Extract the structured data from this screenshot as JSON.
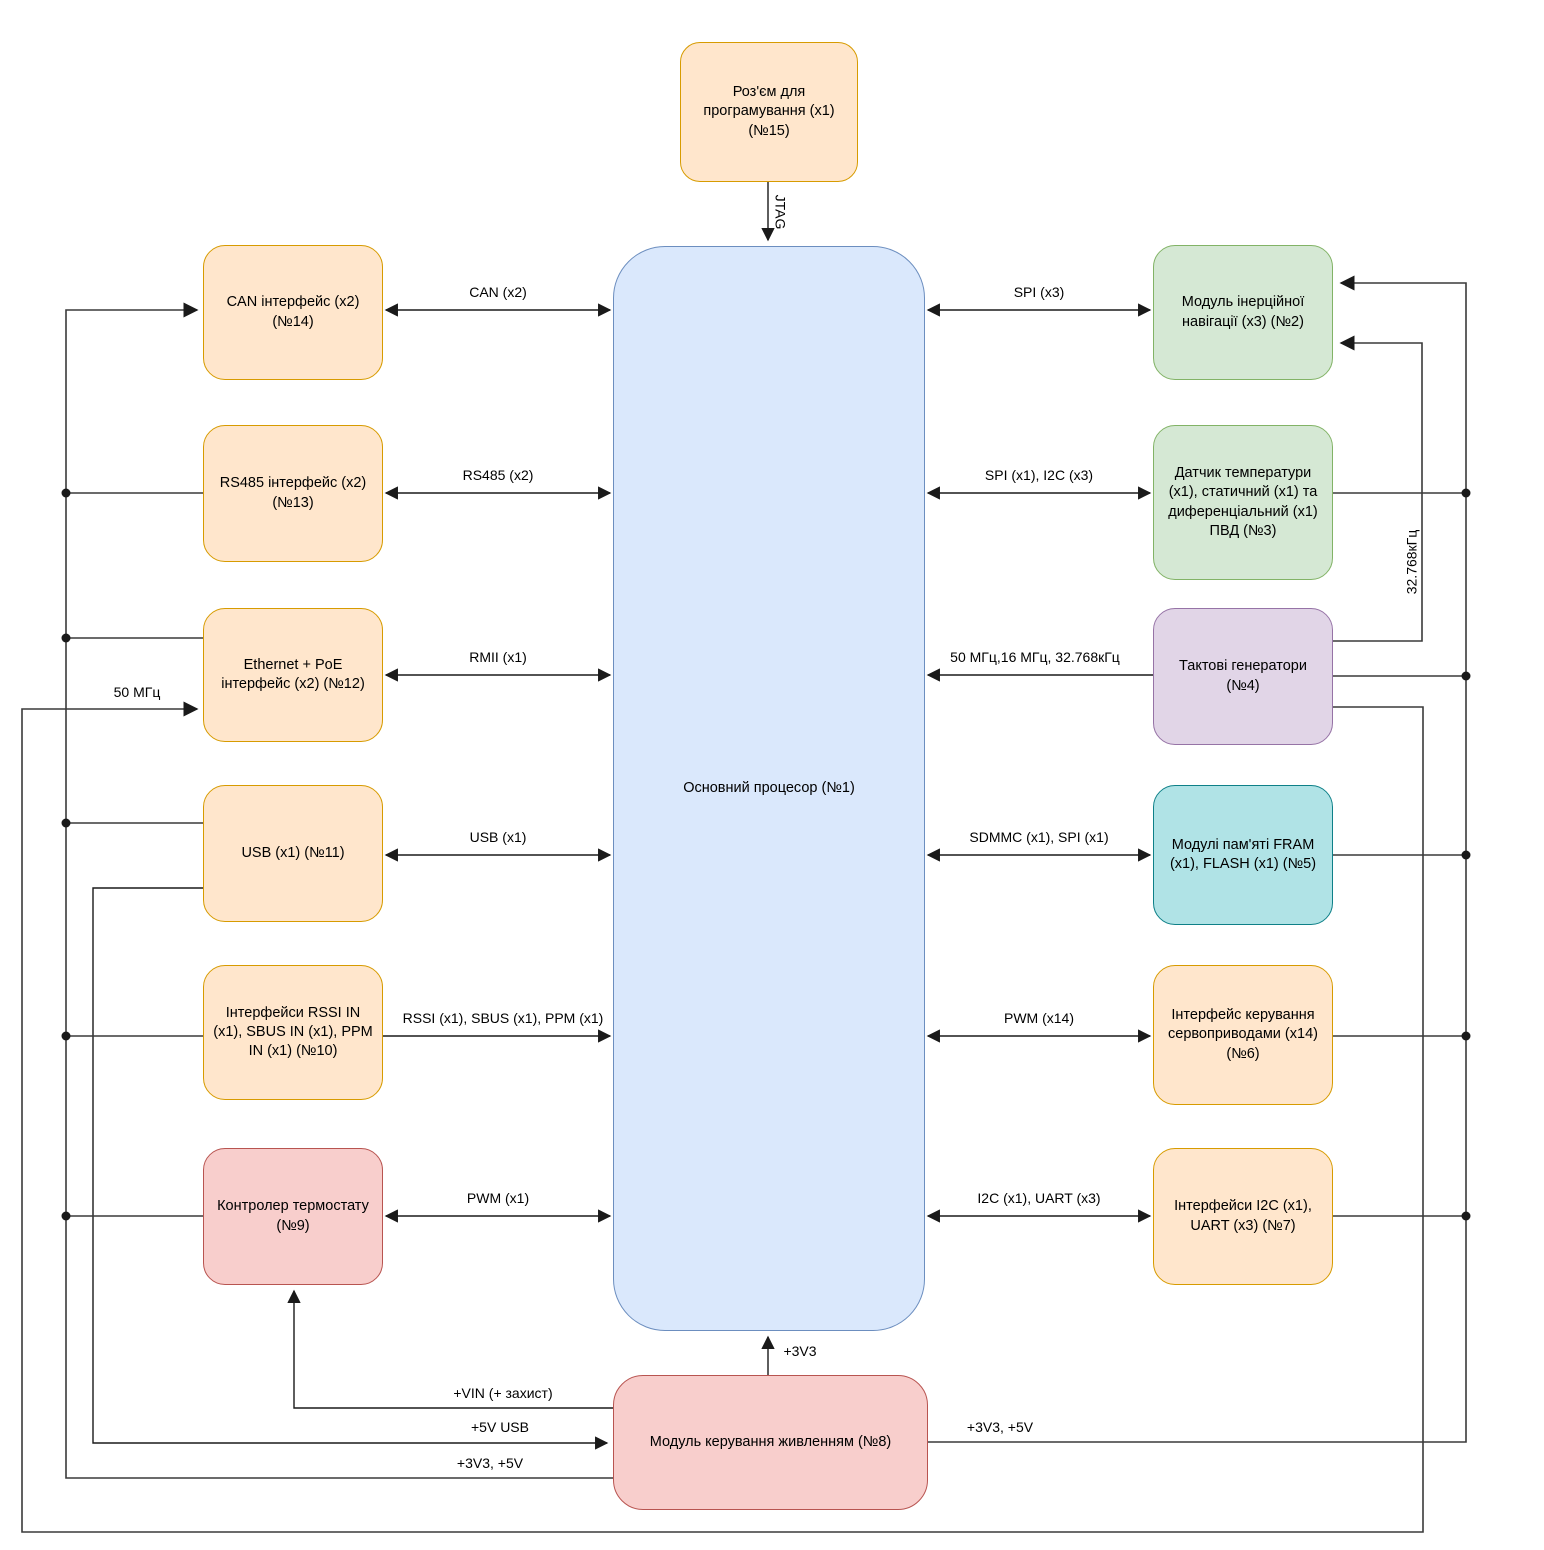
{
  "diagram_title": "",
  "colors": {
    "orange": {
      "fill": "#FFE6CC",
      "stroke": "#D79B00"
    },
    "blue": {
      "fill": "#DAE8FC",
      "stroke": "#6C8EBF"
    },
    "green": {
      "fill": "#D5E8D4",
      "stroke": "#82B366"
    },
    "purple": {
      "fill": "#E1D5E7",
      "stroke": "#9673A6"
    },
    "teal": {
      "fill": "#B0E3E6",
      "stroke": "#0E8088"
    },
    "red": {
      "fill": "#F8CECC",
      "stroke": "#B85450"
    },
    "line": "#1a1a1a"
  },
  "blocks": {
    "programming": {
      "label": "Роз'єм для програмування (x1) (№15)"
    },
    "processor": {
      "label": "Основний процесор (№1)"
    },
    "can": {
      "label": "CAN інтерфейс (x2) (№14)"
    },
    "rs485": {
      "label": "RS485 інтерфейс (x2) (№13)"
    },
    "ethernet": {
      "label": "Ethernet + PoE інтерфейс (x2) (№12)"
    },
    "usb": {
      "label": "USB (x1) (№11)"
    },
    "rc_inputs": {
      "label": "Інтерфейси RSSI IN (x1), SBUS IN (x1), PPM IN (x1) (№10)"
    },
    "thermostat": {
      "label": "Контролер термостату (№9)"
    },
    "imu": {
      "label": "Модуль інерційної навігації (x3) (№2)"
    },
    "sensors": {
      "label": "Датчик температури (x1), статичний (x1) та диференціальний (x1) ПВД (№3)"
    },
    "clocks": {
      "label": "Тактові генератори (№4)"
    },
    "memory": {
      "label": "Модулі пам'яті FRAM (x1), FLASH (x1) (№5)"
    },
    "servo": {
      "label": "Інтерфейс керування сервоприводами (x14) (№6)"
    },
    "i2c_uart": {
      "label": "Інтерфейси I2C (x1), UART (x3) (№7)"
    },
    "power": {
      "label": "Модуль керування живленням (№8)"
    }
  },
  "edges": {
    "jtag": {
      "label": "JTAG"
    },
    "can": {
      "label": "CAN (x2)"
    },
    "rs485": {
      "label": "RS485 (x2)"
    },
    "rmii": {
      "label": "RMII (x1)"
    },
    "usb": {
      "label": "USB (x1)"
    },
    "rc": {
      "label": "RSSI (x1), SBUS (x1), PPM (x1)"
    },
    "pwm_thermo": {
      "label": "PWM (x1)"
    },
    "spi3": {
      "label": "SPI (x3)"
    },
    "spi_i2c": {
      "label": "SPI (x1), I2C (x3)"
    },
    "clk": {
      "label": "50 МГц,16 МГц, 32.768кГц"
    },
    "sdmmc": {
      "label": "SDMMC (x1), SPI (x1)"
    },
    "pwm14": {
      "label": "PWM (x14)"
    },
    "i2c_uart": {
      "label": "I2C (x1), UART (x3)"
    },
    "mhz50": {
      "label": "50 МГц"
    },
    "khz32": {
      "label": "32.768кГц"
    },
    "p3v3": {
      "label": "+3V3"
    },
    "vin": {
      "label": "+VIN (+ захист)"
    },
    "usb5v": {
      "label": "+5V USB"
    },
    "p3v3_5v_left": {
      "label": "+3V3, +5V"
    },
    "p3v3_5v_right": {
      "label": "+3V3, +5V"
    }
  }
}
